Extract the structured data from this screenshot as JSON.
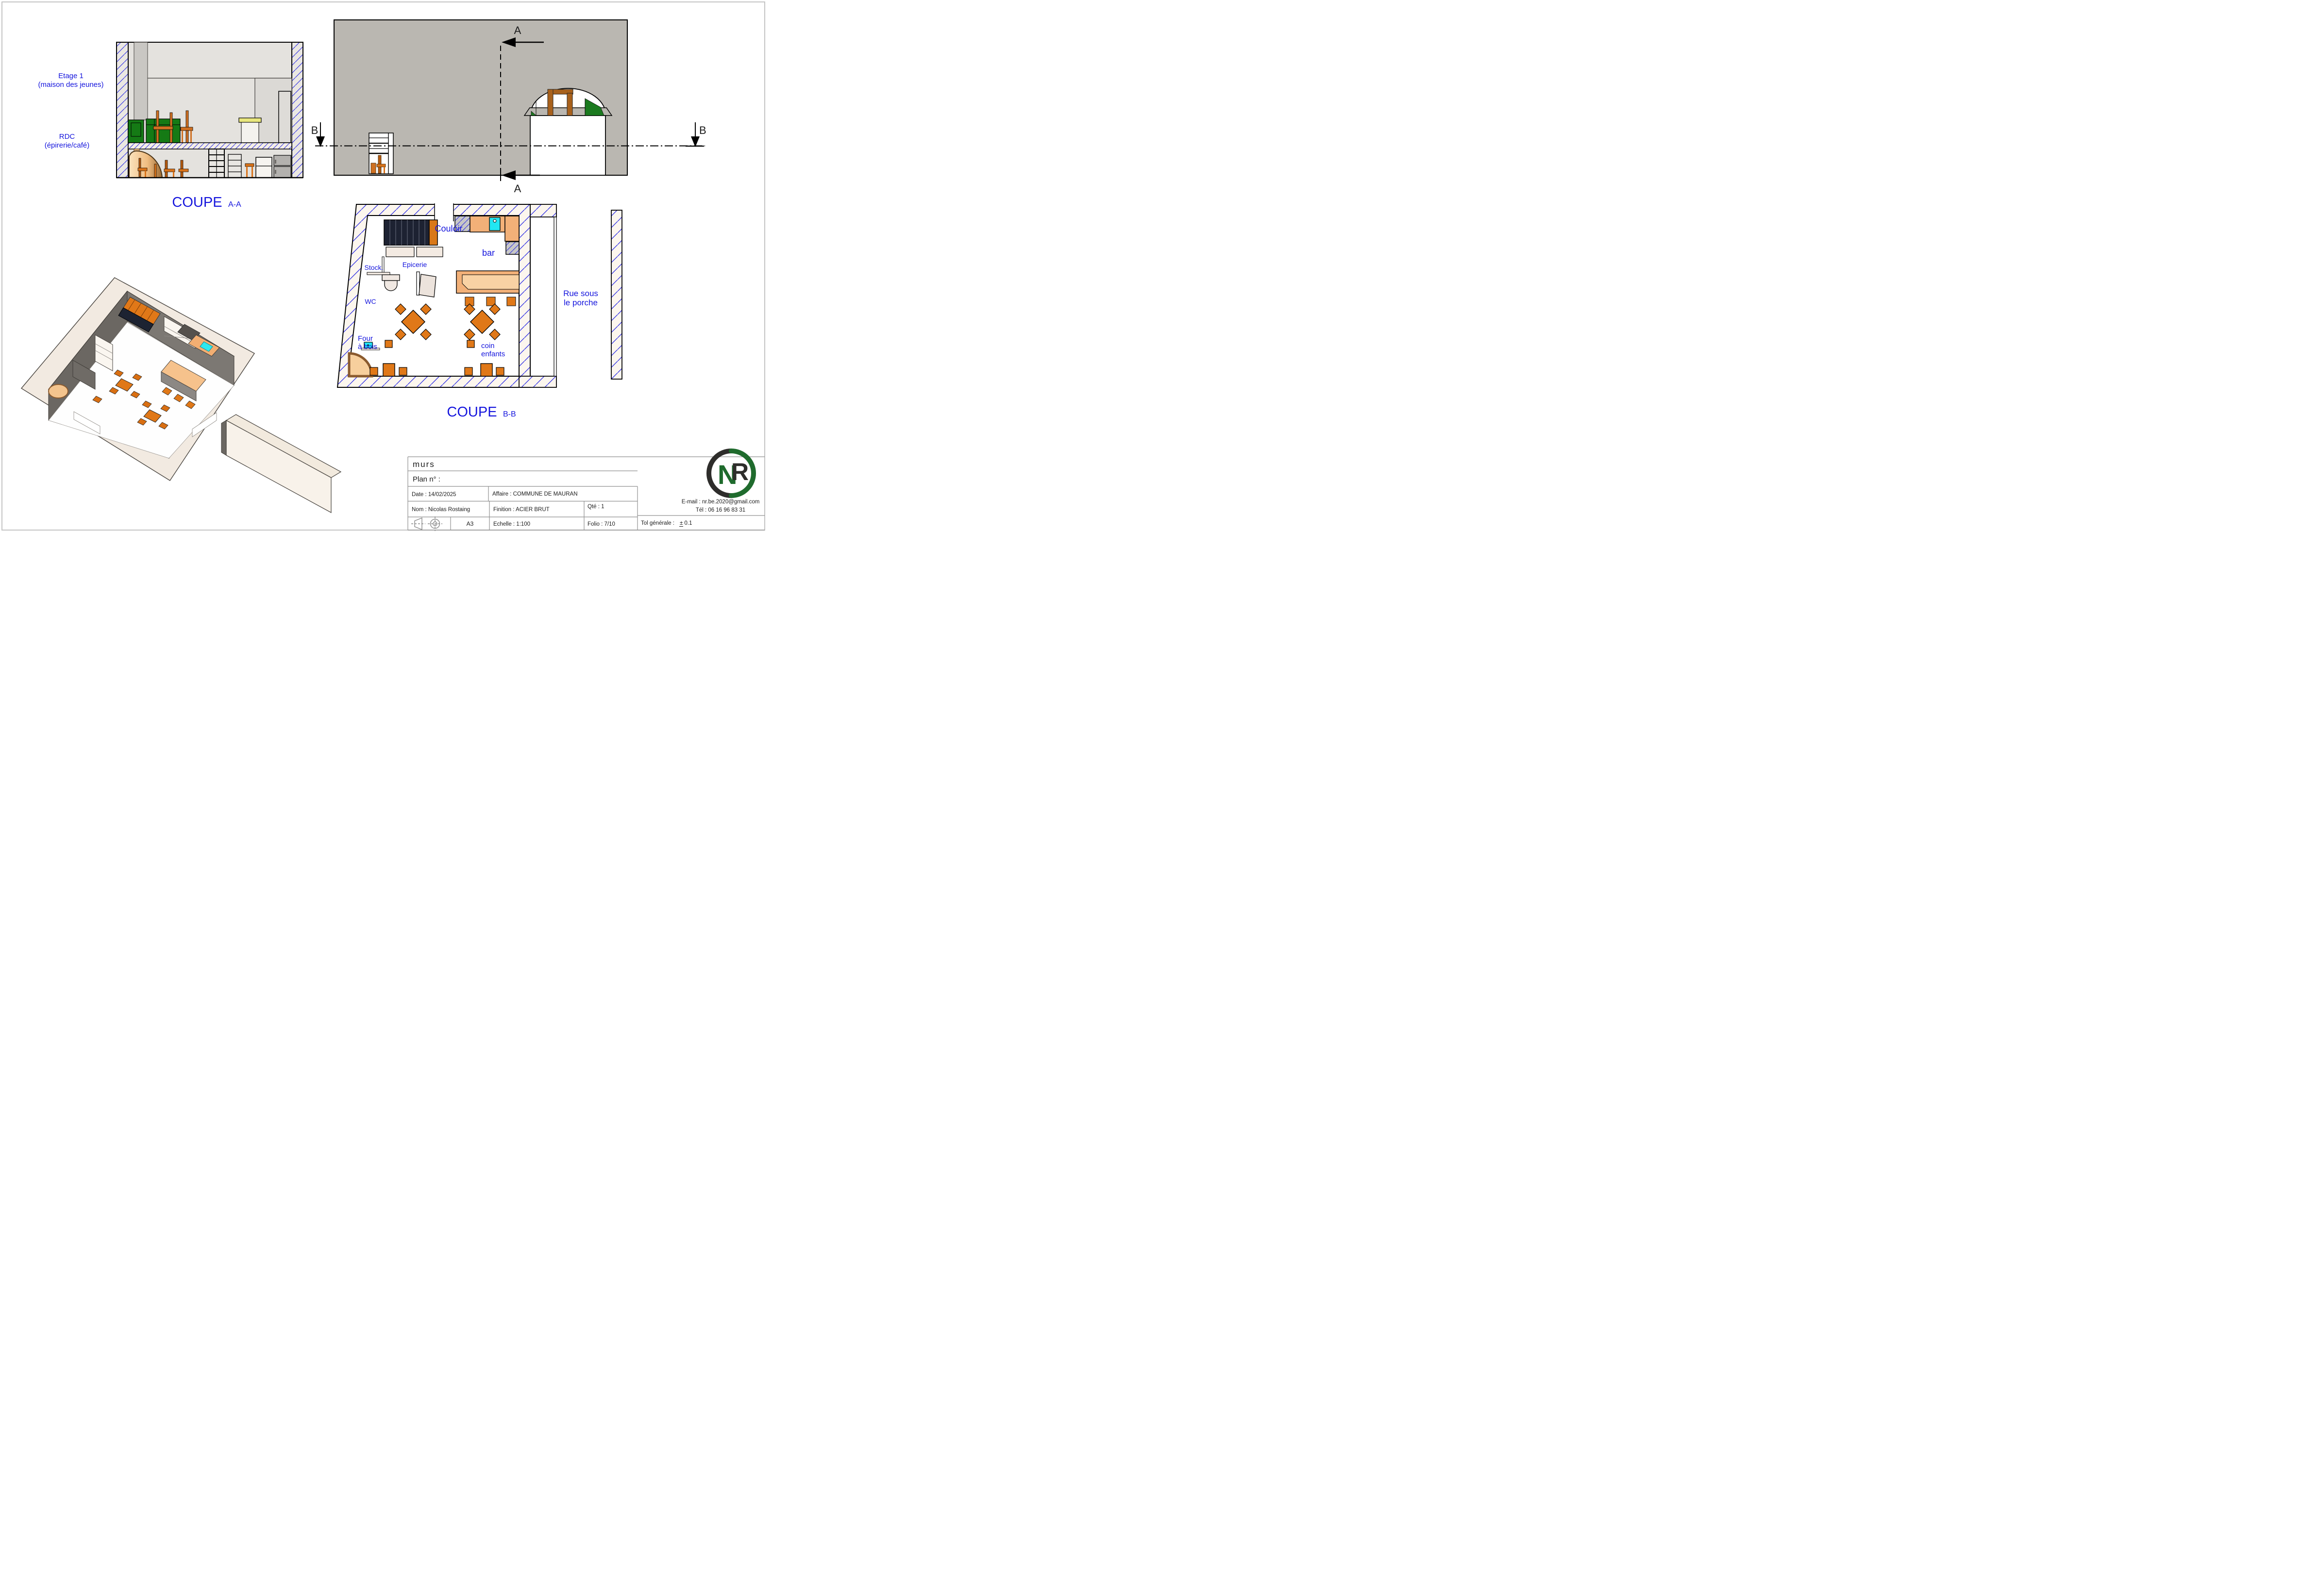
{
  "views": {
    "section_aa": {
      "title": "COUPE",
      "title_sub": "A-A",
      "floor1_line1": "Etage 1",
      "floor1_line2": "(maison des jeunes)",
      "ground_line1": "RDC",
      "ground_line2": "(épirerie/café)"
    },
    "section_bb": {
      "title": "COUPE",
      "title_sub": "B-B",
      "rooms": {
        "couloir": "Couloir",
        "bar": "bar",
        "stock": "Stock.",
        "epicerie": "Epicerie",
        "wc": "WC",
        "four_line1": "Four",
        "four_line2": "à bois",
        "coin_line1": "coin",
        "coin_line2": "enfants"
      },
      "street_line1": "Rue sous",
      "street_line2": "le porche"
    },
    "markers": {
      "a": "A",
      "b": "B"
    }
  },
  "title_block": {
    "part_name": "murs",
    "plan_no": "Plan n° :",
    "date": "Date : 14/02/2025",
    "affaire": "Affaire : COMMUNE DE MAURAN",
    "nom": "Nom : Nicolas Rostaing",
    "finition": "Finition : ACIER BRUT",
    "qte": "Qté : 1",
    "format": "A3",
    "echelle": "Echelle :  1:100",
    "folio": "Folio : 7/10",
    "tol_label": "Tol générale :",
    "tol_value": "± 0.1",
    "email": "E-mail : nr.be.2020@gmail.com",
    "tel": "Tél : 06 16 96 83 31"
  },
  "logo": {
    "letter_n": "N",
    "letter_r": "R"
  },
  "colors": {
    "label_blue": "#1414DD",
    "hatch_blue": "#2424E4",
    "facade_gray": "#BAB7B1",
    "furniture_orange": "#E07818",
    "counter_orange": "#F2B078",
    "sink_cyan": "#22E6F2",
    "sofa_green": "#157A15",
    "logo_green": "#1F6B2D",
    "logo_black": "#2E2D2B"
  }
}
